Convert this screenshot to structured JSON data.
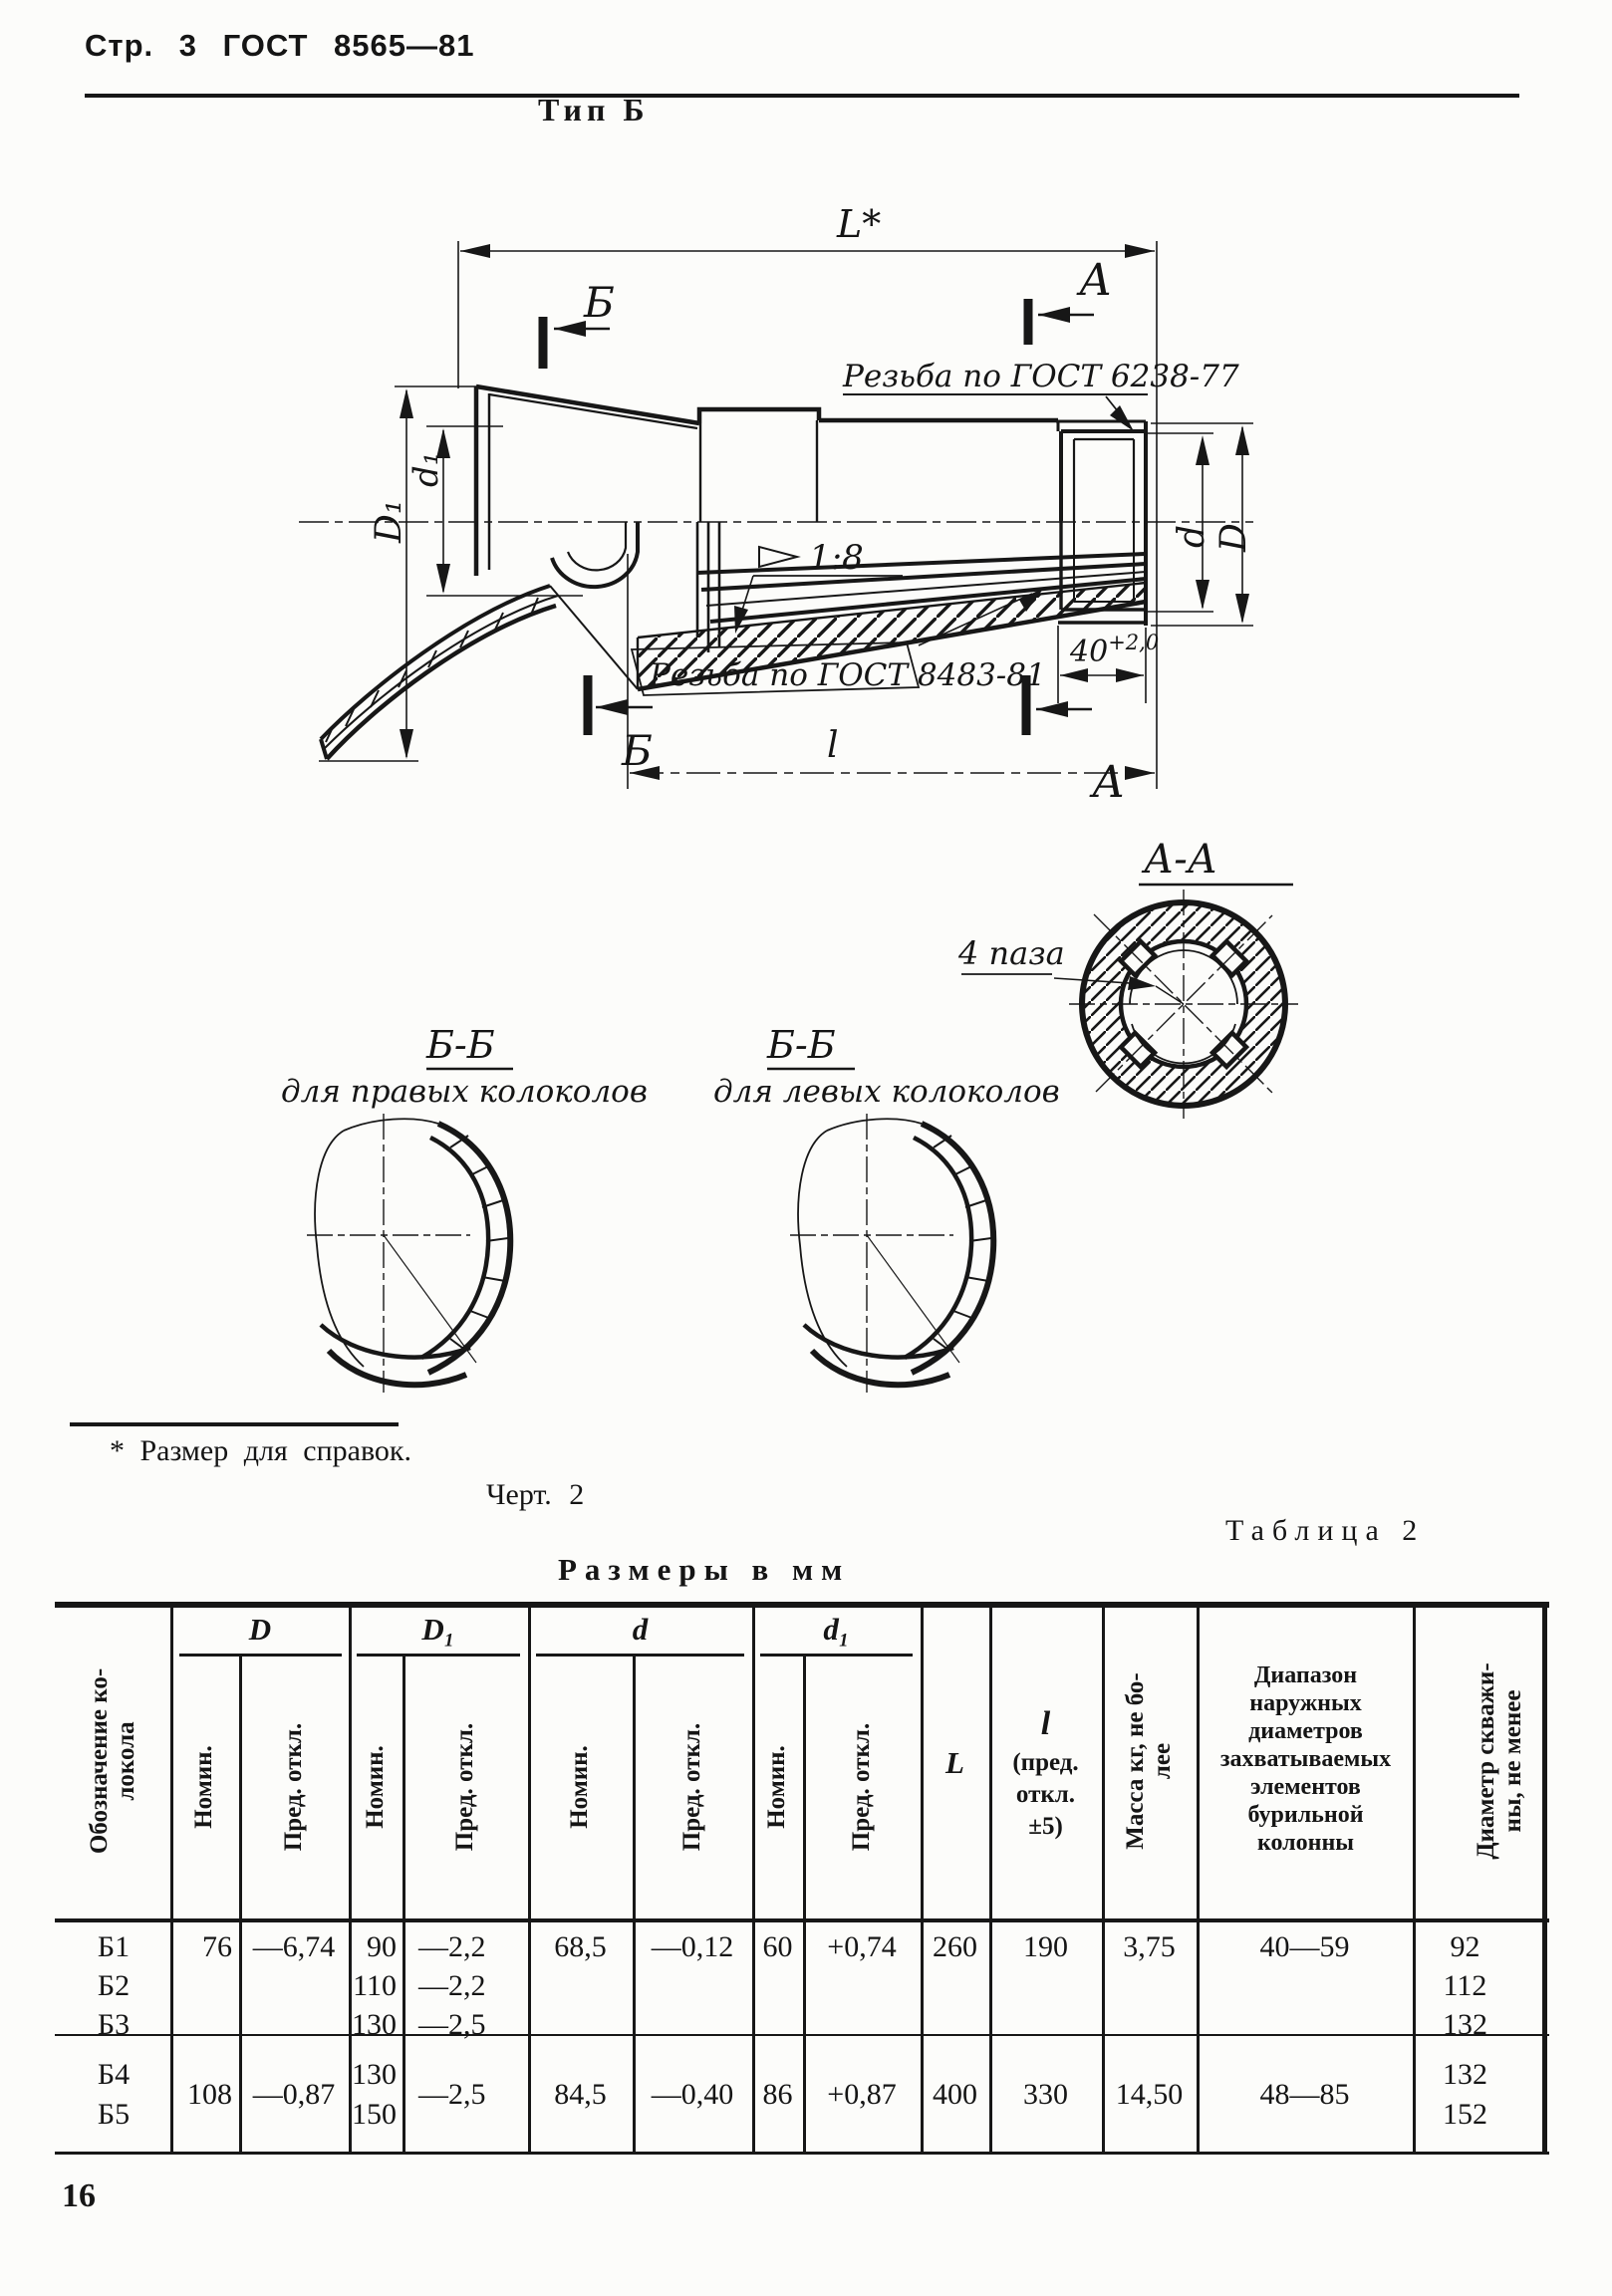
{
  "page": {
    "header": "Стр. 3 ГОСТ 8565—81",
    "figure_title": "Тип  Б",
    "footnote": "* Размер для справок.",
    "figure_caption": "Черт.  2",
    "page_number": "16"
  },
  "drawing": {
    "dim_overall": "L*",
    "dim_thread_len": "l",
    "dim_40_base": "40",
    "dim_40_tol": "+2,0",
    "thread_top_label": "Резьба по ГОСТ 6238-77",
    "thread_bottom_label": "Резьба по ГОСТ 8483-81",
    "taper_label": "1:8",
    "dim_D1": "D₁",
    "dim_d1": "d₁",
    "dim_d": "d",
    "dim_D": "D",
    "marker_A": "А",
    "marker_B": "Б"
  },
  "sections": {
    "AA": {
      "title": "А-А",
      "note": "4 паза"
    },
    "BB_right": {
      "title": "Б-Б",
      "subtitle": "для правых колоколов"
    },
    "BB_left": {
      "title": "Б-Б",
      "subtitle": "для левых колоколов"
    }
  },
  "table": {
    "caption": "Таблица 2",
    "units": "Размеры в мм",
    "headers": {
      "designation_l1": "Обозначение ко-",
      "designation_l2": "локола",
      "D": "D",
      "D1": "D₁",
      "d": "d",
      "d1": "d₁",
      "nom": "Номин.",
      "dev": "Пред. откл.",
      "L": "L",
      "l": "l",
      "l_note1": "(пред.",
      "l_note2": "откл.",
      "l_note3": "±5)",
      "mass_l1": "Масса  кг, не бо-",
      "mass_l2": "лее",
      "range_l1": "Диапазон",
      "range_l2": "наружных",
      "range_l3": "диаметров",
      "range_l4": "захватываемых",
      "range_l5": "элементов",
      "range_l6": "бурильной",
      "range_l7": "колонны",
      "bore_l1": "Диаметр скважи-",
      "bore_l2": "ны, не менее"
    },
    "group1": {
      "designations": [
        "Б1",
        "Б2",
        "Б3"
      ],
      "D_nom": "76",
      "D_dev": "—6,74",
      "D1_nom": [
        "90",
        "110",
        "130"
      ],
      "D1_dev": [
        "—2,2",
        "—2,2",
        "—2,5"
      ],
      "d_nom": "68,5",
      "d_dev": "—0,12",
      "d1_nom": "60",
      "d1_dev": "+0,74",
      "L": "260",
      "l": "190",
      "mass": "3,75",
      "range": "40—59",
      "bore": [
        "92",
        "112",
        "132"
      ]
    },
    "group2": {
      "designations": [
        "Б4",
        "Б5"
      ],
      "D_nom": "108",
      "D_dev": "—0,87",
      "D1_nom": [
        "130",
        "150"
      ],
      "D1_dev": "—2,5",
      "d_nom": "84,5",
      "d_dev": "—0,40",
      "d1_nom": "86",
      "d1_dev": "+0,87",
      "L": "400",
      "l": "330",
      "mass": "14,50",
      "range": "48—85",
      "bore": [
        "132",
        "152"
      ]
    }
  }
}
